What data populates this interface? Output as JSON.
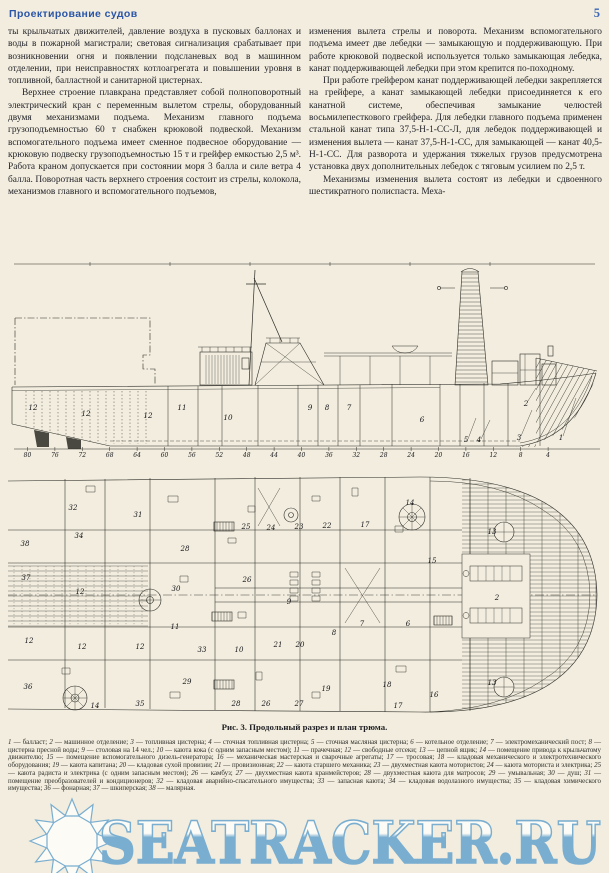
{
  "header": {
    "title": "Проектирование судов",
    "page_number": "5"
  },
  "columns": {
    "left": [
      "ты крыльчатых движителей, давление воздуха в пусковых баллонах и воды в пожарной магистрали; световая сигнализация срабатывает при возникновении огня и появлении подсланевых вод в машинном отделении, при неисправностях котлоагрегата и повышении уровня в топливной, балластной и санитарной цистернах.",
      "Верхнее строение плавкрана представляет собой полноповоротный электрический кран с переменным вылетом стрелы, оборудованный двумя механизмами подъема. Механизм главного подъема грузоподъемностью 60 т снабжен крюковой подвеской. Механизм вспомогательного подъема имеет сменное подвесное оборудование — крюковую подвеску грузоподъемностью 15 т и грейфер емкостью 2,5 м³. Работа краном допускается при состоянии моря 3 балла и силе ветра 4 балла. Поворотная часть верхнего строения состоит из стрелы, колокола, механизмов главного и вспомогательного подъемов,"
    ],
    "right": [
      "изменения вылета стрелы и поворота. Механизм вспомогательного подъема имеет две лебедки — замыкающую и поддерживающую. При работе крюковой подвеской используется только замыкающая лебедка, канат поддерживающей лебедки при этом крепится по-походному.",
      "При работе грейфером канат поддерживающей лебедки закрепляется на грейфере, а канат замыкающей лебедки присоединяется к его канатной системе, обеспечивая замыкание челюстей восьмилепесткового грейфера. Для лебедки главного подъема применен стальной канат типа 37,5-Н-1-СС-Л, для лебедок поддерживающей и изменения вылета — канат 37,5-Н-1-СС, для замыкающей — канат 40,5-Н-1-СС. Для разворота и удержания тяжелых грузов предусмотрена установка двух дополнительных лебедок с тяговым усилием по 2,5 т.",
      "Механизмы изменения вылета состоят из лебедки и сдвоенного шестикратного полиспаста. Меха-"
    ]
  },
  "figure": {
    "caption": "Рис. 3. Продольный разрез и план трюма.",
    "frame_numbers": [
      "80",
      "76",
      "72",
      "68",
      "64",
      "60",
      "56",
      "52",
      "48",
      "44",
      "40",
      "36",
      "32",
      "28",
      "24",
      "20",
      "16",
      "12",
      "8",
      "4"
    ],
    "profile_labels": [
      {
        "t": "12",
        "x": 33,
        "y": 152
      },
      {
        "t": "12",
        "x": 86,
        "y": 158
      },
      {
        "t": "12",
        "x": 148,
        "y": 160
      },
      {
        "t": "11",
        "x": 182,
        "y": 152
      },
      {
        "t": "10",
        "x": 228,
        "y": 162
      },
      {
        "t": "9",
        "x": 310,
        "y": 152
      },
      {
        "t": "8",
        "x": 327,
        "y": 152
      },
      {
        "t": "7",
        "x": 349,
        "y": 152
      },
      {
        "t": "6",
        "x": 422,
        "y": 164
      },
      {
        "t": "5",
        "x": 466,
        "y": 184
      },
      {
        "t": "4",
        "x": 479,
        "y": 184
      },
      {
        "t": "3",
        "x": 519,
        "y": 182
      },
      {
        "t": "2",
        "x": 526,
        "y": 148
      },
      {
        "t": "1",
        "x": 561,
        "y": 182
      }
    ],
    "plan_labels": [
      {
        "t": "32",
        "x": 73,
        "y": 42
      },
      {
        "t": "31",
        "x": 138,
        "y": 49
      },
      {
        "t": "34",
        "x": 79,
        "y": 70
      },
      {
        "t": "38",
        "x": 25,
        "y": 78
      },
      {
        "t": "28",
        "x": 185,
        "y": 83
      },
      {
        "t": "25",
        "x": 246,
        "y": 61
      },
      {
        "t": "24",
        "x": 271,
        "y": 62
      },
      {
        "t": "23",
        "x": 299,
        "y": 61
      },
      {
        "t": "22",
        "x": 327,
        "y": 60
      },
      {
        "t": "17",
        "x": 365,
        "y": 59
      },
      {
        "t": "14",
        "x": 410,
        "y": 37
      },
      {
        "t": "15",
        "x": 432,
        "y": 95
      },
      {
        "t": "13",
        "x": 492,
        "y": 66
      },
      {
        "t": "37",
        "x": 26,
        "y": 112
      },
      {
        "t": "12",
        "x": 80,
        "y": 126
      },
      {
        "t": "30",
        "x": 176,
        "y": 123
      },
      {
        "t": "26",
        "x": 247,
        "y": 114
      },
      {
        "t": "9",
        "x": 289,
        "y": 136
      },
      {
        "t": "11",
        "x": 175,
        "y": 161
      },
      {
        "t": "8",
        "x": 334,
        "y": 167
      },
      {
        "t": "7",
        "x": 362,
        "y": 158
      },
      {
        "t": "6",
        "x": 408,
        "y": 158
      },
      {
        "t": "2",
        "x": 497,
        "y": 132
      },
      {
        "t": "33",
        "x": 202,
        "y": 184
      },
      {
        "t": "10",
        "x": 239,
        "y": 184
      },
      {
        "t": "21",
        "x": 278,
        "y": 179
      },
      {
        "t": "20",
        "x": 300,
        "y": 179
      },
      {
        "t": "12",
        "x": 29,
        "y": 175
      },
      {
        "t": "12",
        "x": 82,
        "y": 181
      },
      {
        "t": "12",
        "x": 140,
        "y": 181
      },
      {
        "t": "36",
        "x": 28,
        "y": 221
      },
      {
        "t": "29",
        "x": 187,
        "y": 216
      },
      {
        "t": "19",
        "x": 326,
        "y": 223
      },
      {
        "t": "18",
        "x": 387,
        "y": 219
      },
      {
        "t": "16",
        "x": 434,
        "y": 229
      },
      {
        "t": "35",
        "x": 140,
        "y": 238
      },
      {
        "t": "14",
        "x": 95,
        "y": 240
      },
      {
        "t": "28",
        "x": 236,
        "y": 238
      },
      {
        "t": "26",
        "x": 266,
        "y": 238
      },
      {
        "t": "27",
        "x": 299,
        "y": 238
      },
      {
        "t": "17",
        "x": 398,
        "y": 240
      },
      {
        "t": "13",
        "x": 492,
        "y": 217
      }
    ]
  },
  "legend": {
    "items": [
      {
        "n": "1",
        "t": "балласт"
      },
      {
        "n": "2",
        "t": "машинное отделение"
      },
      {
        "n": "3",
        "t": "топливная цистерна"
      },
      {
        "n": "4",
        "t": "сточная топливная цистерна"
      },
      {
        "n": "5",
        "t": "сточная масляная цистерна"
      },
      {
        "n": "6",
        "t": "котельное отделение"
      },
      {
        "n": "7",
        "t": "электромеханический пост"
      },
      {
        "n": "8",
        "t": "цистерна пресной воды"
      },
      {
        "n": "9",
        "t": "столовая на 14 чел."
      },
      {
        "n": "10",
        "t": "каюта кока (с одним запасным местом)"
      },
      {
        "n": "11",
        "t": "прачечная"
      },
      {
        "n": "12",
        "t": "свободные отсеки"
      },
      {
        "n": "13",
        "t": "цепной ящик"
      },
      {
        "n": "14",
        "t": "помещение привода к крыльчатому движителю"
      },
      {
        "n": "15",
        "t": "помещение вспомогательного дизель-генератора"
      },
      {
        "n": "16",
        "t": "механическая мастерская и сварочные агрегаты"
      },
      {
        "n": "17",
        "t": "тросовая"
      },
      {
        "n": "18",
        "t": "кладовая механического и электротехнического оборудования"
      },
      {
        "n": "19",
        "t": "каюта капитана"
      },
      {
        "n": "20",
        "t": "кладовая сухой провизии"
      },
      {
        "n": "21",
        "t": "провизионная"
      },
      {
        "n": "22",
        "t": "каюта старшего механика"
      },
      {
        "n": "23",
        "t": "двухместная каюта мотористов"
      },
      {
        "n": "24",
        "t": "каюта моториста и электрика"
      },
      {
        "n": "25",
        "t": "каюта радиста и электрика (с одним запасным местом)"
      },
      {
        "n": "26",
        "t": "камбуз"
      },
      {
        "n": "27",
        "t": "двухместная каюта кранмейстеров"
      },
      {
        "n": "28",
        "t": "двухместная каюта для матросов"
      },
      {
        "n": "29",
        "t": "умывальная"
      },
      {
        "n": "30",
        "t": "душ"
      },
      {
        "n": "31",
        "t": "помещение преобразователей и кондиционеров"
      },
      {
        "n": "32",
        "t": "кладовая аварийно-спасательного имущества"
      },
      {
        "n": "33",
        "t": "запасная каюта"
      },
      {
        "n": "34",
        "t": "кладовая водолазного имущества"
      },
      {
        "n": "35",
        "t": "кладовая химического имущества"
      },
      {
        "n": "36",
        "t": "фонарная"
      },
      {
        "n": "37",
        "t": "шкиперская"
      },
      {
        "n": "38",
        "t": "малярная"
      }
    ]
  },
  "watermark": {
    "text": "SEATRACKER.RU",
    "color": "#74abd0"
  }
}
